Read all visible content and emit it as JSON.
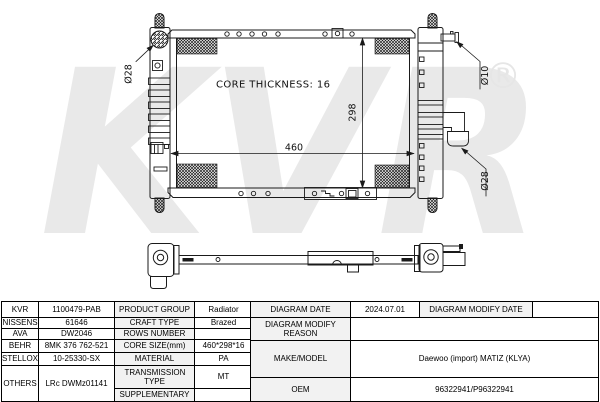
{
  "colors": {
    "line": "#1a1a1a",
    "watermark": "#e9e9e9",
    "label_cell_bg": "#f2f2f2",
    "table_border": "#000000"
  },
  "drawing": {
    "watermark": "KVR",
    "registered_mark": "®",
    "core_thickness": "CORE THICKNESS: 16",
    "width_dim": "460",
    "height_dim": "298",
    "left_cap_dia": "Ø28",
    "inlet_dia": "Ø10",
    "outlet_dia": "Ø28"
  },
  "table": {
    "left": {
      "brands": [
        "KVR",
        "NISSENS",
        "AVA",
        "BEHR",
        "STELLOX",
        "OTHERS"
      ],
      "codes": [
        "1100479-PAB",
        "61646",
        "DW2046",
        "8MK 376 762-521",
        "10-25330-SX",
        "LRc DWMz01141"
      ],
      "attrs": [
        "PRODUCT GROUP",
        "CRAFT TYPE",
        "ROWS NUMBER",
        "CORE SIZE(mm)",
        "MATERIAL",
        "TRANSMISSION TYPE",
        "SUPPLEMENTARY"
      ],
      "values": [
        "Radiator",
        "Brazed",
        "",
        "460*298*16",
        "PA",
        "MT",
        ""
      ]
    },
    "right": {
      "diagram_date_label": "DIAGRAM DATE",
      "diagram_date_value": "2024.07.01",
      "modify_date_label": "DIAGRAM MODIFY DATE",
      "modify_date_value": "",
      "modify_reason_label": "DIAGRAM MODIFY REASON",
      "modify_reason_value": "",
      "make_model_label": "MAKE/MODEL",
      "make_model_value": "Daewoo (import) MATIZ (KLYA)",
      "oem_label": "OEM",
      "oem_value": "96322941/P96322941"
    }
  }
}
